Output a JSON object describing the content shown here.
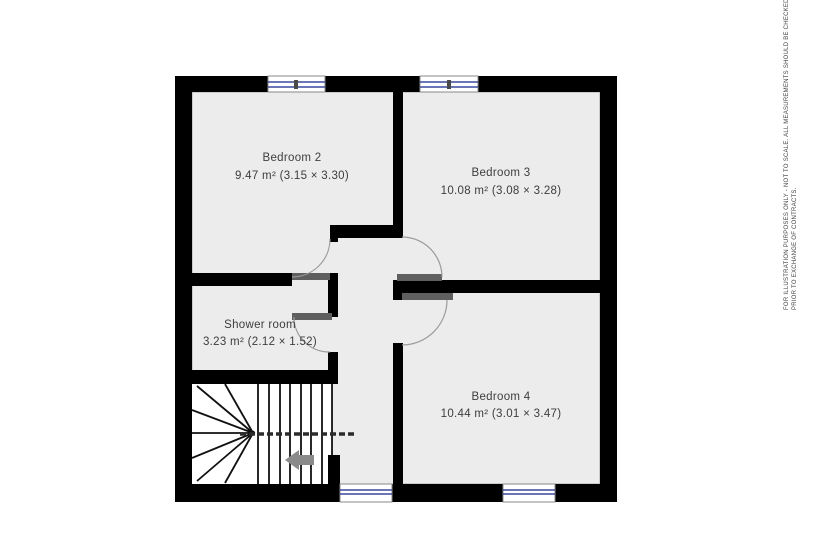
{
  "rooms": [
    {
      "name": "Bedroom 2",
      "dims": "9.47 m² (3.15 × 3.30)"
    },
    {
      "name": "Bedroom 3",
      "dims": "10.08 m² (3.08 × 3.28)"
    },
    {
      "name": "Shower room",
      "dims": "3.23 m² (2.12 × 1.52)"
    },
    {
      "name": "Bedroom 4",
      "dims": "10.44 m² (3.01 × 3.47)"
    }
  ],
  "disclaimer": {
    "line1": "FOR ILLUSTRATION PURPOSES ONLY - NOT TO SCALE.  ALL MEASUREMENTS SHOULD BE CHECKED BY THE PURCHASER",
    "line2": "PRIOR TO EXCHANGE OF CONTRACTS."
  },
  "colors": {
    "wall": "#000000",
    "room_fill": "#ececec",
    "stair_fill": "#ffffff",
    "inner_line": "#a8a8a8",
    "window_glass": "#3a49a0",
    "door_leaf": "#5f5f5f",
    "swing_arc": "#9b9b9b",
    "stair_line": "#111111",
    "arrow": "#8a8a8a"
  }
}
